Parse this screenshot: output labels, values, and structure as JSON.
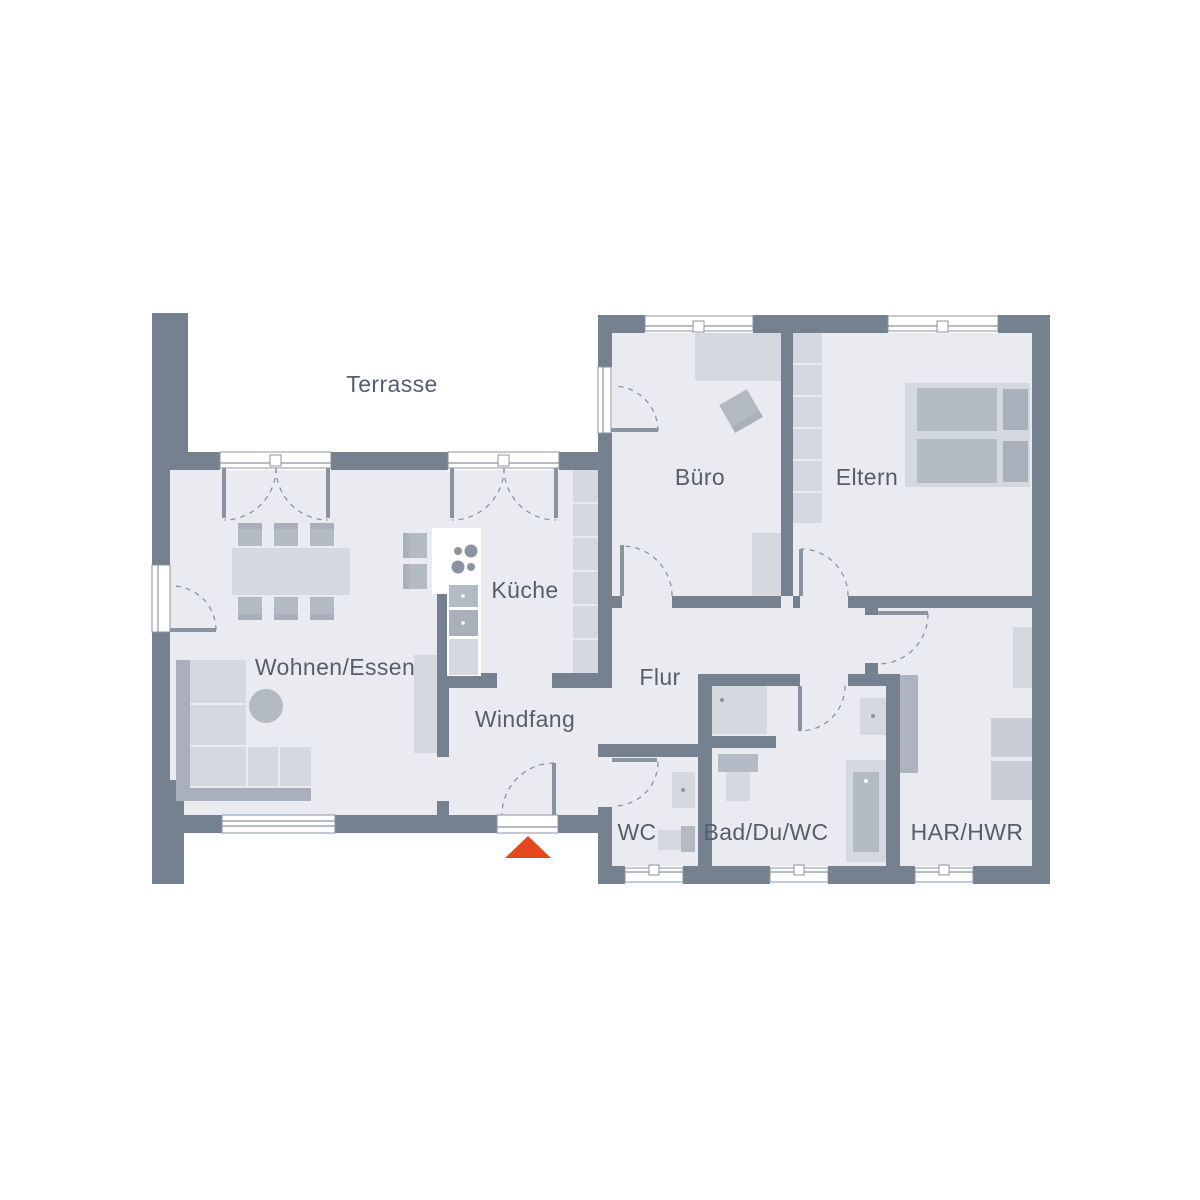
{
  "floorplan": {
    "rooms": {
      "terrasse": {
        "label": "Terrasse"
      },
      "wohnen_essen": {
        "label": "Wohnen/Essen"
      },
      "kueche": {
        "label": "Küche"
      },
      "windfang": {
        "label": "Windfang"
      },
      "buero": {
        "label": "Büro"
      },
      "eltern": {
        "label": "Eltern"
      },
      "flur": {
        "label": "Flur"
      },
      "wc": {
        "label": "WC"
      },
      "bad": {
        "label": "Bad/Du/WC"
      },
      "har_hwr": {
        "label": "HAR/HWR"
      }
    },
    "colors": {
      "wall": "#76818F",
      "floor": "#E9EBF1",
      "furniture-light": "#D5D8DE",
      "furniture-medium": "#B4BAC4",
      "furniture-dark": "#A9B0BB",
      "appliance": "#C9CDD5",
      "chase": "#AEB4BF",
      "frame-line": "#8A94A0",
      "background": "#FFFFFF",
      "entrance-accent": "#E5471D",
      "label-text": "#555E6B"
    }
  }
}
